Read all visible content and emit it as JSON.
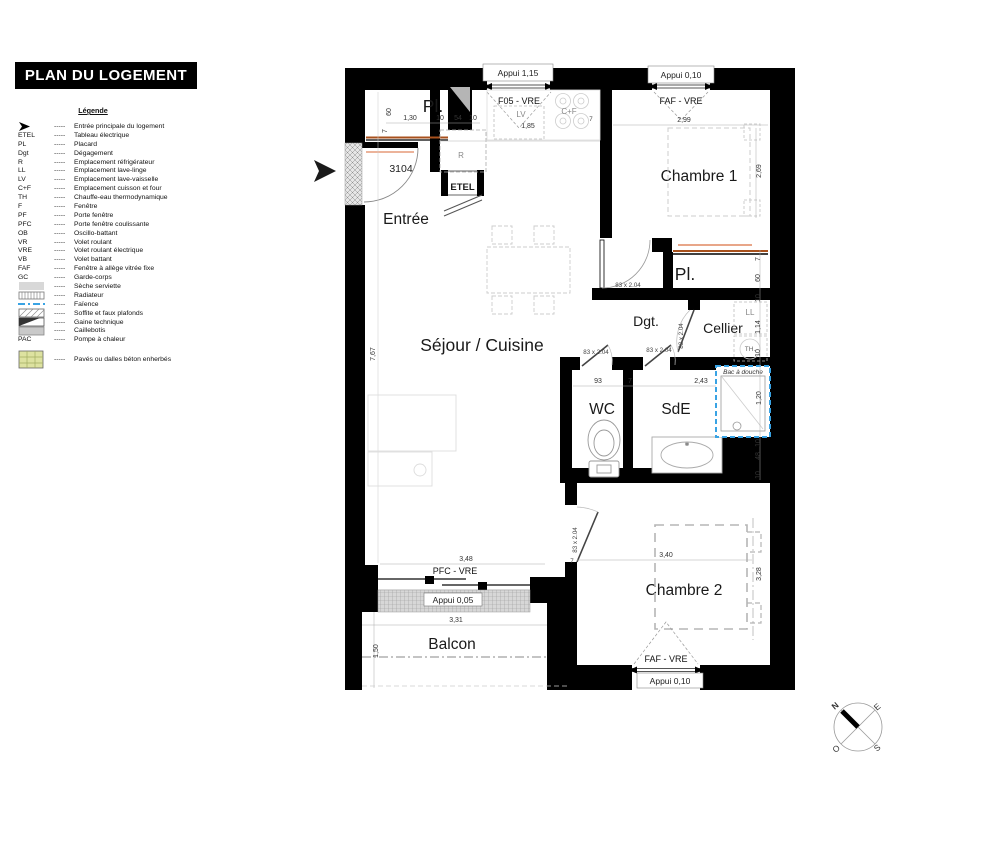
{
  "title": "PLAN DU LOGEMENT",
  "legend": {
    "heading": "Légende",
    "dash": "-----",
    "items": [
      {
        "abbr": "",
        "label": "Entrée principale du logement"
      },
      {
        "abbr": "ETEL",
        "label": "Tableau électrique"
      },
      {
        "abbr": "PL",
        "label": "Placard"
      },
      {
        "abbr": "Dgt",
        "label": "Dégagement"
      },
      {
        "abbr": "R",
        "label": "Emplacement réfrigérateur"
      },
      {
        "abbr": "LL",
        "label": "Emplacement lave-linge"
      },
      {
        "abbr": "LV",
        "label": "Emplacement lave-vaisselle"
      },
      {
        "abbr": "C+F",
        "label": "Emplacement cuisson et four"
      },
      {
        "abbr": "TH",
        "label": "Chauffe-eau thermodynamique"
      },
      {
        "abbr": "F",
        "label": "Fenêtre"
      },
      {
        "abbr": "PF",
        "label": "Porte fenêtre"
      },
      {
        "abbr": "PFC",
        "label": "Porte fenêtre coulissante"
      },
      {
        "abbr": "OB",
        "label": "Oscillo-battant"
      },
      {
        "abbr": "VR",
        "label": "Volet roulant"
      },
      {
        "abbr": "VRE",
        "label": "Volet roulant électrique"
      },
      {
        "abbr": "VB",
        "label": "Volet battant"
      },
      {
        "abbr": "FAF",
        "label": "Fenêtre à allège vitrée fixe"
      },
      {
        "abbr": "GC",
        "label": "Garde-corps"
      },
      {
        "abbr": "",
        "label": "Sèche serviette"
      },
      {
        "abbr": "",
        "label": "Radiateur"
      },
      {
        "abbr": "",
        "label": "Faïence"
      },
      {
        "abbr": "",
        "label": "Soffite et faux plafonds"
      },
      {
        "abbr": "",
        "label": "Gaine technique"
      },
      {
        "abbr": "",
        "label": "Caillebotis"
      },
      {
        "abbr": "PAC",
        "label": "Pompe à chaleur"
      },
      {
        "abbr": "",
        "label": "Pavés ou dalles béton enherbés"
      }
    ]
  },
  "plan": {
    "unit_number": "3104",
    "rooms": {
      "entree": "Entrée",
      "sejour": "Séjour / Cuisine",
      "chambre1": "Chambre 1",
      "chambre2": "Chambre 2",
      "wc": "WC",
      "sde": "SdE",
      "cellier": "Cellier",
      "dgt": "Dgt.",
      "pl1": "Pl.",
      "pl2": "Pl.",
      "balcon": "Balcon"
    },
    "fixtures": {
      "r": "R",
      "etel": "ETEL",
      "lv": "LV",
      "cf": "C+F",
      "ll": "LL",
      "th": "TH.",
      "bac": "Bac à douche"
    },
    "openings": {
      "kitchen_window": "F05 - VRE",
      "kitchen_appui": "Appui 1,15",
      "ch1_window": "FAF - VRE",
      "ch1_appui": "Appui 0,10",
      "balcony_door": "PFC - VRE",
      "balcony_appui": "Appui 0,05",
      "ch2_window": "FAF - VRE",
      "ch2_appui": "Appui 0,10",
      "door_size": "83 x 2.04"
    },
    "dims": {
      "d7": "7",
      "d10": "10",
      "d48": "48",
      "d54": "54",
      "d60": "60",
      "d93": "93",
      "d114": "1,14",
      "d120": "1,20",
      "d130": "1,30",
      "d150": "1,50",
      "d185": "1,85",
      "d243": "2,43",
      "d269": "2,69",
      "d299": "2,99",
      "d328": "3,28",
      "d331": "3,31",
      "d340": "3,40",
      "d348": "3,48",
      "d767": "7,67"
    }
  },
  "compass": {
    "n": "N",
    "e": "E",
    "s": "S",
    "o": "O"
  },
  "colors": {
    "wall": "#000000",
    "rail_orange": "#a8511d",
    "radiator_salmon": "#e59a78",
    "shower_blue": "#39a3e4",
    "paves_fill": "#dde2a0"
  }
}
